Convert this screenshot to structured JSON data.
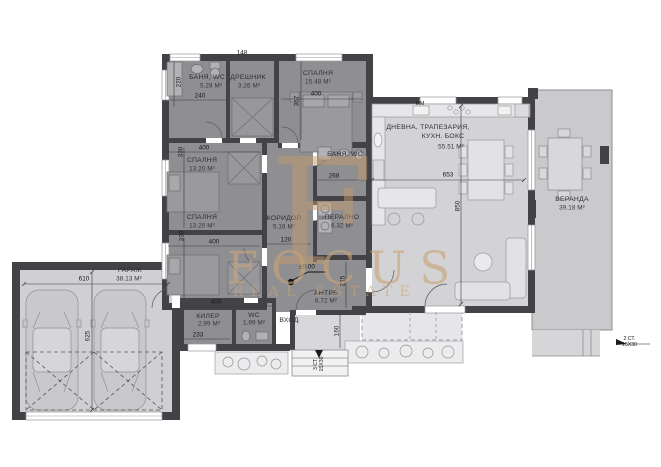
{
  "watermark": {
    "monogram": "F",
    "title": "FOCUS",
    "subtitle": "REAL ESTATE"
  },
  "rooms": {
    "bath_top": {
      "label": "БАНЯ, WC",
      "area": "5.28 М²"
    },
    "closet": {
      "label": "ДРЕШНИК",
      "area": "3.26 М²"
    },
    "bedroom_top": {
      "label": "СПАЛНЯ",
      "area": "15.48 М²"
    },
    "bedroom_left_1": {
      "label": "СПАЛНЯ",
      "area": "13.20 М²"
    },
    "bedroom_left_2": {
      "label": "СПАЛНЯ",
      "area": "13.20 М²"
    },
    "corridor": {
      "label": "КОРИДОР",
      "area": "5.16 М²"
    },
    "bath_mid": {
      "label": "БАНЯ, WC"
    },
    "laundry": {
      "label": "ПЕРАЛНО",
      "area": "6.32 М²"
    },
    "living": {
      "label_line1": "ДНЕВНА, ТРАПЕЗАРИЯ,",
      "label_line2": "КУХН. БОКС",
      "area": "55.51 М²"
    },
    "veranda": {
      "label": "ВЕРАНДА",
      "area": "39.18 М²"
    },
    "garage": {
      "label": "ГАРАЖ",
      "area": "38.13 М²"
    },
    "pantry": {
      "label": "КИЛЕР",
      "area": "2.99 М²"
    },
    "wc": {
      "label": "WC",
      "area": "1.99 М²"
    },
    "entry_hall": {
      "label": "АНТРЕ",
      "area": "8.72 М²"
    },
    "entrance": {
      "label": "ВХОД"
    }
  },
  "dimensions": {
    "closet_width": "148",
    "bath_width": "240",
    "bath_depth": "220",
    "room_width_400": "400",
    "bedroom_top_depth": "367",
    "bedroom_depth_330": "330",
    "corridor_width": "120",
    "bath_mid_width": "268",
    "living_width": "653",
    "living_depth": "850",
    "garage_width": "610",
    "garage_depth": "625",
    "pantry_width": "233",
    "entrance_depth": "160",
    "entry_hall_depth": "215",
    "level_mark": "±0.00",
    "appliance_mark": "ММ"
  },
  "annotations": {
    "steps_entrance": {
      "line1": "3 СТ.",
      "line2": "15Х30"
    },
    "steps_terrace": {
      "line1": "2 СТ.",
      "line2": "15Х30"
    }
  },
  "colors": {
    "watermark_gold": "#c9a478",
    "wall_dark": "#434347",
    "wing_floor": "#8f8f92",
    "living_floor": "#d3d3d5",
    "veranda_floor": "#cacacc",
    "garage_floor": "#d0d0d2"
  }
}
